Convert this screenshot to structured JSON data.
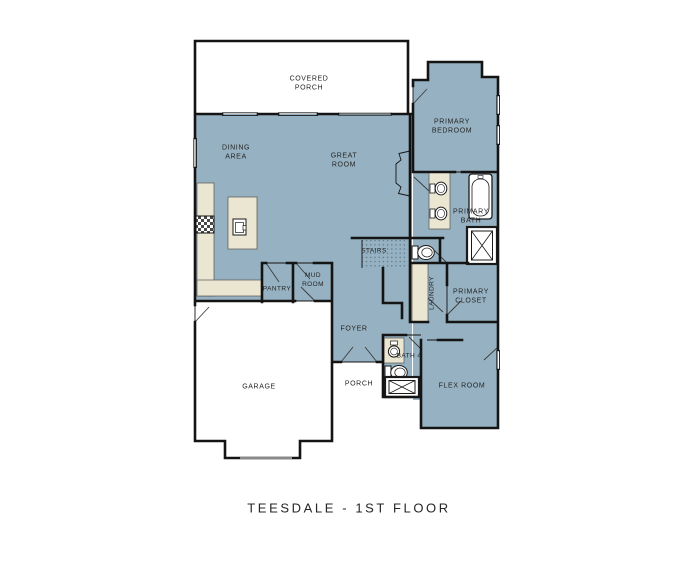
{
  "title": "TEESDALE - 1ST FLOOR",
  "floor_plan": {
    "rooms": [
      {
        "id": "covered-porch",
        "label": "COVERED\nPORCH"
      },
      {
        "id": "dining-area",
        "label": "DINING\nAREA"
      },
      {
        "id": "great-room",
        "label": "GREAT\nROOM"
      },
      {
        "id": "primary-bedroom",
        "label": "PRIMARY\nBEDROOM"
      },
      {
        "id": "primary-bath",
        "label": "PRIMARY\nBATH"
      },
      {
        "id": "stairs",
        "label": "STAIRS"
      },
      {
        "id": "pantry",
        "label": "PANTRY"
      },
      {
        "id": "mud-room",
        "label": "MUD\nROOM"
      },
      {
        "id": "laundry",
        "label": "LAUNDRY"
      },
      {
        "id": "primary-closet",
        "label": "PRIMARY\nCLOSET"
      },
      {
        "id": "foyer",
        "label": "FOYER"
      },
      {
        "id": "garage",
        "label": "GARAGE"
      },
      {
        "id": "porch",
        "label": "PORCH"
      },
      {
        "id": "bath-4",
        "label": "BATH 4"
      },
      {
        "id": "flex-room",
        "label": "FLEX ROOM"
      }
    ],
    "fixtures": [
      "stove",
      "kitchen-island-sink",
      "double-vanity-sinks",
      "bathtub",
      "primary-shower",
      "water-closet-toilet",
      "bath4-sink",
      "bath4-toilet",
      "bath4-shower",
      "garage-door"
    ]
  },
  "colors": {
    "background": "#ffffff",
    "house_fill": "#96b1c1",
    "cabinet_fill": "#ebe6d1",
    "wall": "#141414",
    "garage_door": "#8a8a8a",
    "stipple": "#5e7a8e",
    "text": "#252525"
  }
}
